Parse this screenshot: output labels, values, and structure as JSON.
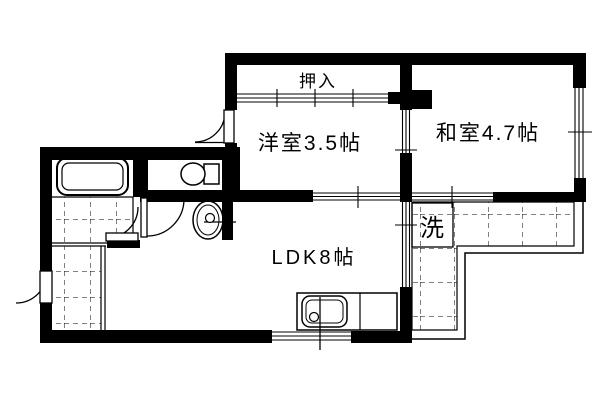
{
  "page": {
    "background": "#ffffff",
    "line_color": "#000000",
    "type": "apartment-floorplan"
  },
  "floorplan": {
    "labels": {
      "closet": "押入",
      "western_room": "洋室3.5帖",
      "japanese_room": "和室4.7帖",
      "ldk": "LDK8帖",
      "laundry": "洗"
    },
    "features": [
      "bathtub",
      "toilet",
      "washbasin",
      "kitchen-sink",
      "washing-machine-space",
      "entry-genkan-tiled",
      "balcony-tiled-L-shape",
      "sliding-doors",
      "swing-doors",
      "windows"
    ]
  }
}
